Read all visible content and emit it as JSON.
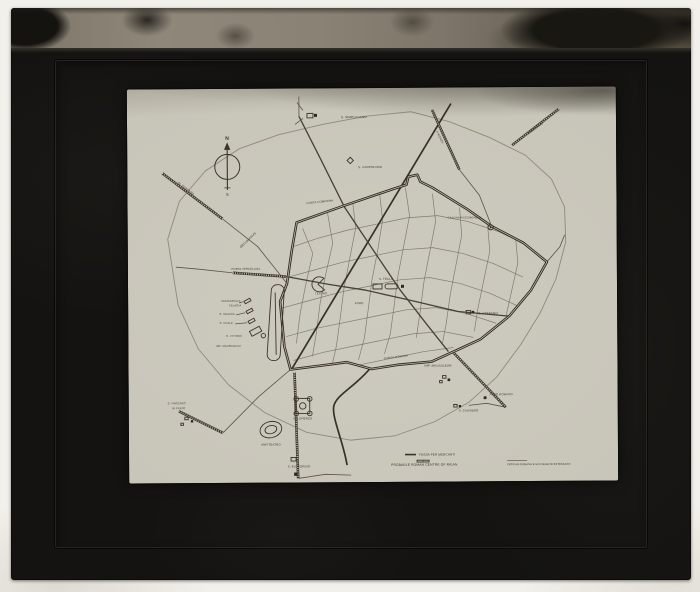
{
  "scene": {
    "description": "Photograph of a glass lantern slide with black mount and mottled binding tape, holding a photographic print of a map of Roman Milan",
    "mount_color": "#141311",
    "tape_color": "#8a8274",
    "print_color": "#c9c6ba",
    "ink_color": "#3c342a"
  },
  "map": {
    "compass": {
      "north": "N",
      "south": "S"
    },
    "captions": {
      "title": "PROBABLE ROMAN CENTRE OF MILAN",
      "subtitle": "CERCHIA ROMANA E SUCCESSIVE ESTENSIONI",
      "legend": "FOSSA PER MERCANTI"
    },
    "labels": [
      {
        "id": "compass-n",
        "t": "N",
        "x": 100,
        "y": 51,
        "s": 5,
        "b": 1
      },
      {
        "id": "compass-s",
        "t": "S",
        "x": 100,
        "y": 107,
        "s": 4
      },
      {
        "id": "s-simpliciano",
        "t": "S. SIMPLICIANO",
        "x": 214,
        "y": 30,
        "s": 3.1,
        "a": "start"
      },
      {
        "id": "s-carpoforo",
        "t": "S. CARPOFORO",
        "x": 231,
        "y": 80,
        "s": 2.9,
        "a": "start"
      },
      {
        "id": "porta-comasina",
        "t": "PORTA COMASINA",
        "x": 206,
        "y": 113,
        "s": 2.8,
        "a": "end",
        "r": -6
      },
      {
        "id": "decumanus",
        "t": "DECUMANUS",
        "x": 121,
        "y": 152,
        "s": 3.1,
        "r": -44
      },
      {
        "id": "porta-vercellina",
        "t": "PORTA VERCELLINA",
        "x": 118,
        "y": 181,
        "s": 2.7
      },
      {
        "id": "teatro",
        "t": "TEATRO",
        "x": 193,
        "y": 206,
        "s": 2.8
      },
      {
        "id": "s-tecla",
        "t": "S. TECLA",
        "x": 258,
        "y": 192,
        "s": 2.9
      },
      {
        "id": "foro",
        "t": "FORO",
        "x": 231,
        "y": 216,
        "s": 2.8
      },
      {
        "id": "porta-romana",
        "t": "PORTA ROMANA",
        "x": 268,
        "y": 270,
        "s": 2.8,
        "r": -7
      },
      {
        "id": "s-stefano",
        "t": "S. STEFANO",
        "x": 350,
        "y": 227,
        "s": 3.1,
        "a": "start"
      },
      {
        "id": "imp-mausoleum-e",
        "t": "IMP. MAUSOLEUM",
        "x": 296,
        "y": 279,
        "s": 2.9,
        "a": "start"
      },
      {
        "id": "arco-romano",
        "t": "ARCO ROMANO",
        "x": 361,
        "y": 308,
        "s": 2.8,
        "a": "start"
      },
      {
        "id": "s-calimero",
        "t": "S. CALIMERO",
        "x": 330,
        "y": 324,
        "s": 2.8,
        "a": "start"
      },
      {
        "id": "s-lorenzo",
        "t": "S. LORENZO",
        "x": 174,
        "y": 331,
        "s": 2.9
      },
      {
        "id": "anfiteatro",
        "t": "ANFITEATRO",
        "x": 142,
        "y": 357,
        "s": 2.9
      },
      {
        "id": "s-eustorgio",
        "t": "S. EUSTORGIO",
        "x": 170,
        "y": 379,
        "s": 2.9
      },
      {
        "id": "ermagora-1",
        "t": "ERMAGORA E",
        "x": 103,
        "y": 213,
        "s": 2.6
      },
      {
        "id": "ermagora-2",
        "t": "PELAGIA",
        "x": 107,
        "y": 217.5,
        "s": 2.6
      },
      {
        "id": "s-valeria",
        "t": "S. VALERIA",
        "x": 99,
        "y": 226,
        "s": 2.6
      },
      {
        "id": "s-vitale",
        "t": "S. VITALE",
        "x": 98,
        "y": 235,
        "s": 2.6
      },
      {
        "id": "s-vittore",
        "t": "S. VITTORE",
        "x": 106,
        "y": 248,
        "s": 2.6
      },
      {
        "id": "imp-mausoleum-w",
        "t": "IMP. MAUSOLEUM",
        "x": 100,
        "y": 258,
        "s": 2.6
      },
      {
        "id": "s-vincenzo-1",
        "t": "S. VINCENZO",
        "x": 48,
        "y": 315,
        "s": 2.6
      },
      {
        "id": "s-vincenzo-2",
        "t": "IN PRATO",
        "x": 50,
        "y": 320,
        "s": 2.6
      },
      {
        "id": "al-verbano",
        "t": "AL VERBANO",
        "x": 58,
        "y": 100,
        "s": 2.9,
        "r": 38
      },
      {
        "id": "a-monza",
        "t": "A MONZA",
        "x": 312,
        "y": 50,
        "s": 2.8,
        "r": 64
      },
      {
        "id": "a-bergamo",
        "t": "A BERGAMO",
        "x": 409,
        "y": 42,
        "s": 2.8,
        "r": -35
      },
      {
        "id": "cascina",
        "t": "CASCINA POZZOBONELLI",
        "x": 337,
        "y": 131,
        "s": 2.5
      },
      {
        "id": "legend-fossa",
        "t": "FOSSA PER MERCANTI",
        "x": 290,
        "y": 368,
        "s": 3.0,
        "a": "start"
      },
      {
        "id": "caption-title",
        "t": "PROBABLE ROMAN CENTRE OF MILAN",
        "x": 262,
        "y": 378,
        "s": 3.3,
        "a": "start"
      },
      {
        "id": "caption-subtitle",
        "t": "CERCHIA ROMANA E SUCCESSIVE ESTENSIONI",
        "x": 378,
        "y": 378,
        "s": 2.5,
        "a": "start"
      }
    ]
  }
}
